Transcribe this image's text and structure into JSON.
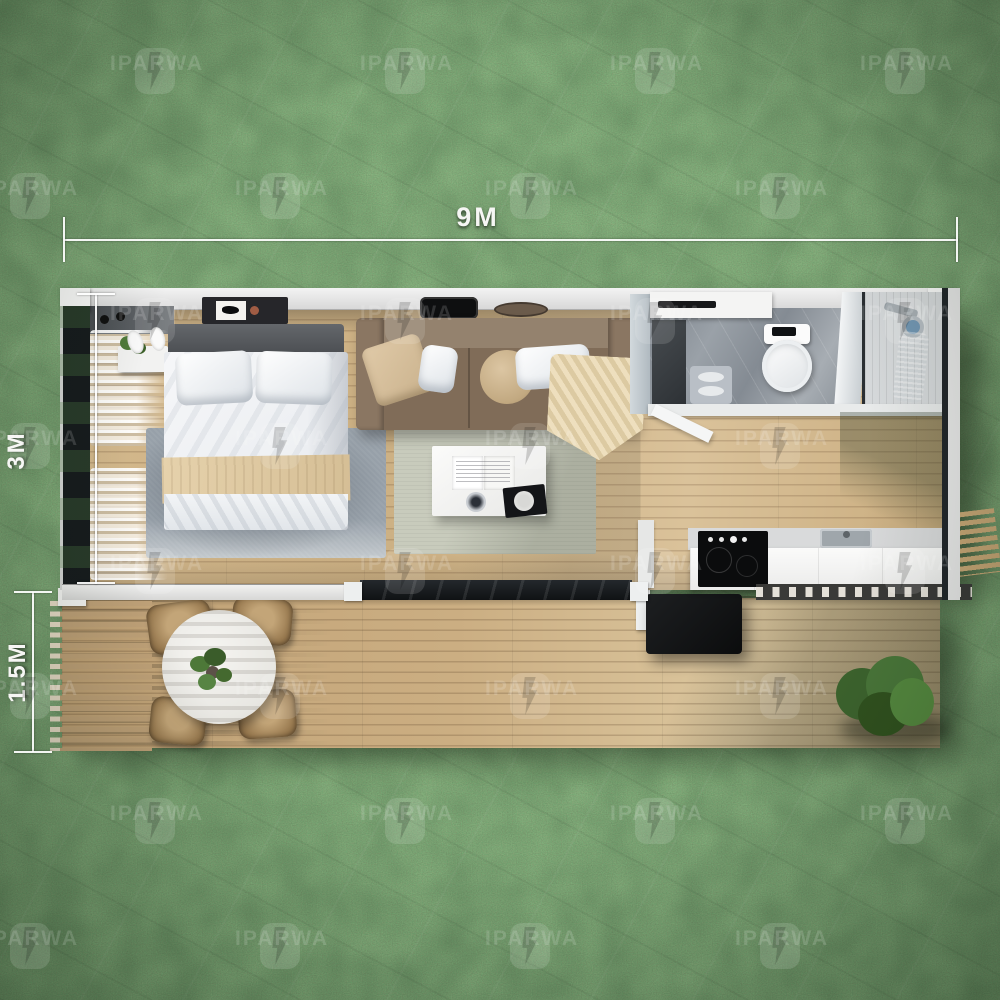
{
  "dimensions": {
    "width_label": "9M",
    "depth_label": "3M",
    "deck_depth_label": "1.5M"
  },
  "watermark": {
    "brand": "IPARWA"
  },
  "colors": {
    "grass_base": "#3f5c34",
    "wall": "#ededed",
    "wood_interior": "#d0b487",
    "wood_deck": "#c8aa7d",
    "sofa_brown": "#84705c",
    "rug_bedroom": "#97a0a9",
    "rug_living": "#c8cbbc",
    "marble": "#8d949c",
    "glass_dark": "#171b1f",
    "accent_blue": "#5d87a8",
    "wood_slat": "#bfa178"
  }
}
